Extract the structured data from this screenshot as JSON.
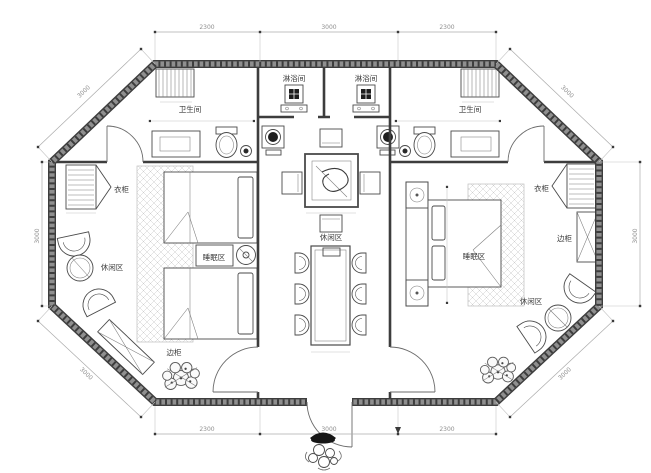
{
  "drawing": {
    "rooms": {
      "bathroom_left": "卫生间",
      "bathroom_right": "卫生间",
      "shower_left": "淋浴间",
      "shower_right": "淋浴间",
      "sleeping_left": "睡眠区",
      "sleeping_right": "睡眠区",
      "lounge_left": "休闲区",
      "lounge_center": "休闲区",
      "lounge_right": "休闲区"
    },
    "furniture": {
      "wardrobe_left": "衣柜",
      "wardrobe_right": "衣柜",
      "side_cabinet_left": "边柜",
      "side_cabinet_right": "边柜"
    },
    "dimensions": {
      "top_left": "2300",
      "top_mid": "3000",
      "top_right": "2300",
      "bottom_left": "2300",
      "bottom_mid": "3000",
      "bottom_right": "2300",
      "left_side": "3000",
      "right_side": "3000",
      "diag_top_left": "3000",
      "diag_top_right": "3000",
      "diag_bottom_left": "3000",
      "diag_bottom_right": "3000"
    },
    "colors": {
      "wall": "#3d3d3d",
      "wall_hatch": "#8f8f8f",
      "furniture_line": "#4a4a4a",
      "rug_hatch": "#cdcdcd",
      "dim_line": "#ababab",
      "dim_text": "#8f8f8f",
      "paper": "#ffffff"
    }
  }
}
